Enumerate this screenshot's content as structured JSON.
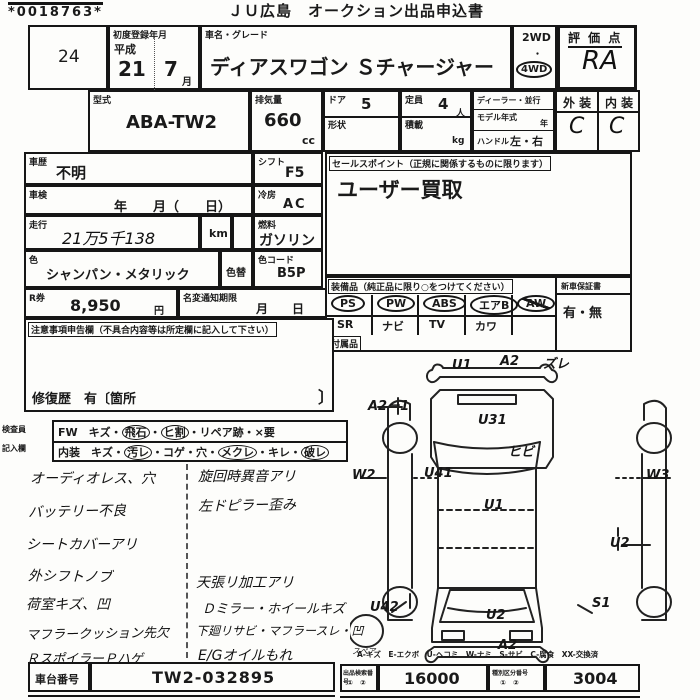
{
  "colors": {
    "ink": "#1a1a1a",
    "paper": "#fdfdfb"
  },
  "header": {
    "barcode": "*0018763*",
    "title": "ＪＵ広島　オークション出品申込書"
  },
  "row1": {
    "lot_no": "24",
    "first_reg_label": "初度登録年月",
    "era": "平成",
    "year": "21",
    "month": "7",
    "month_unit": "月",
    "car_name_label": "車名・グレード",
    "car_name": "ディアスワゴン Ｓチャージャー",
    "drive_2wd": "2WD",
    "drive_4wd": "4WD",
    "score_label": "評 価 点",
    "score": "RA"
  },
  "row2": {
    "model_label": "型式",
    "model": "ABA-TW2",
    "disp_label": "排気量",
    "disp": "660",
    "disp_unit": "cc",
    "door_label": "ドア",
    "door": "5",
    "shape_label": "形状",
    "cap_label": "定員",
    "cap": "4",
    "cap_unit": "人",
    "load_label": "積載",
    "load_unit": "kg",
    "dealer_label": "ディーラー・並行",
    "modelyear_label": "モデル年式",
    "modelyear_unit": "年",
    "handle_label": "ハンドル",
    "handle": "左・右",
    "ext_label": "外 装",
    "ext": "C",
    "int_label": "内 装",
    "int": "C"
  },
  "rows": {
    "hist_label": "車歴",
    "hist": "不明",
    "shift_label": "シフト",
    "shift": "F5",
    "insp_label": "車検",
    "insp": "年　　月（　　日）",
    "ac_label": "冷房",
    "ac": "AC",
    "run_label": "走行",
    "run": "21万5千138",
    "run_unit": "km",
    "fuel_label": "燃料",
    "fuel": "ガソリン",
    "color_label": "色",
    "color": "シャンパン・メタリック",
    "color_chg_label": "色替",
    "color_code_label": "色コード",
    "color_code": "B5P",
    "r_label": "R券",
    "r_val": "8,950",
    "r_unit": "円",
    "namechg_label": "名変通知期限",
    "namechg_val": "月　　日"
  },
  "sales": {
    "label": "セールスポイント（正規に関係するものに限ります）",
    "value": "ユーザー買取"
  },
  "equipment": {
    "label": "装備品（純正品に限り○をつけてください）",
    "i1": "PS",
    "i2": "PW",
    "i3": "ABS",
    "i4": "エアB",
    "i5": "AW",
    "j1": "SR",
    "j2": "ナビ",
    "j3": "TV",
    "j4": "カワ",
    "warranty_label": "新車保証書",
    "warranty": "有・無",
    "acc_label": "付属品"
  },
  "notes_box": {
    "label": "注意事項申告欄（不具合内容等は所定欄に記入して下さい）",
    "repair": "修復歴　有〔箇所",
    "bracket": "〕"
  },
  "inspector": {
    "lbl1": "検査員",
    "lbl2": "記入欄",
    "r1_pre": "FW　キズ・",
    "r1_c1": "飛石",
    "r1_m1": "・",
    "r1_c2": "ヒ割",
    "r1_post": "・リペア跡・×要",
    "r2_pre": "内装　キズ・",
    "r2_c1": "汚レ",
    "r2_m1": "・コゲ・穴・",
    "r2_c2": "メクレ",
    "r2_m2": "・キレ・",
    "r2_c3": "破レ"
  },
  "hand": {
    "left": [
      "オーディオレス、穴",
      "バッテリー不良",
      "シートカバーアリ",
      "外シフトノブ",
      "荷室キズ、凹",
      "マフラークッション先欠",
      "ＲスポイラーＰハゲ"
    ],
    "mid": [
      "旋回時異音アリ",
      "左ドピラー歪み",
      "天張リ加工アリ",
      "Ｄミラー・ホイールキズ",
      "下廻リサビ・マフラースレ・凹",
      "E/Gオイルもれ"
    ],
    "spare": "スペア"
  },
  "diagram": {
    "u1_front": "U1",
    "a2_front": "A2",
    "zure": "ズレ",
    "a2_1": "A2－1",
    "u31": "U31",
    "hibi": "ヒビ",
    "w2": "W2",
    "u41": "U41",
    "w3": "W3",
    "u1_roof": "U1",
    "u2_right": "U2",
    "u42": "U42",
    "s1": "S1",
    "u2_rear": "U2",
    "a2_rear": "A2"
  },
  "footer": {
    "legend": "A-キズ　E-エクボ　U-ヘコミ　W-ナミ　S-サビ　C-腐食　XX-交換済",
    "chassis_label": "車台番号",
    "chassis": "TW2-032895",
    "n1_label": "出品検索番号",
    "n1_sub": "①　②",
    "n1": "16000",
    "n2_label": "種別区分番号",
    "n2_sub": "①　②",
    "n2": "3004"
  }
}
